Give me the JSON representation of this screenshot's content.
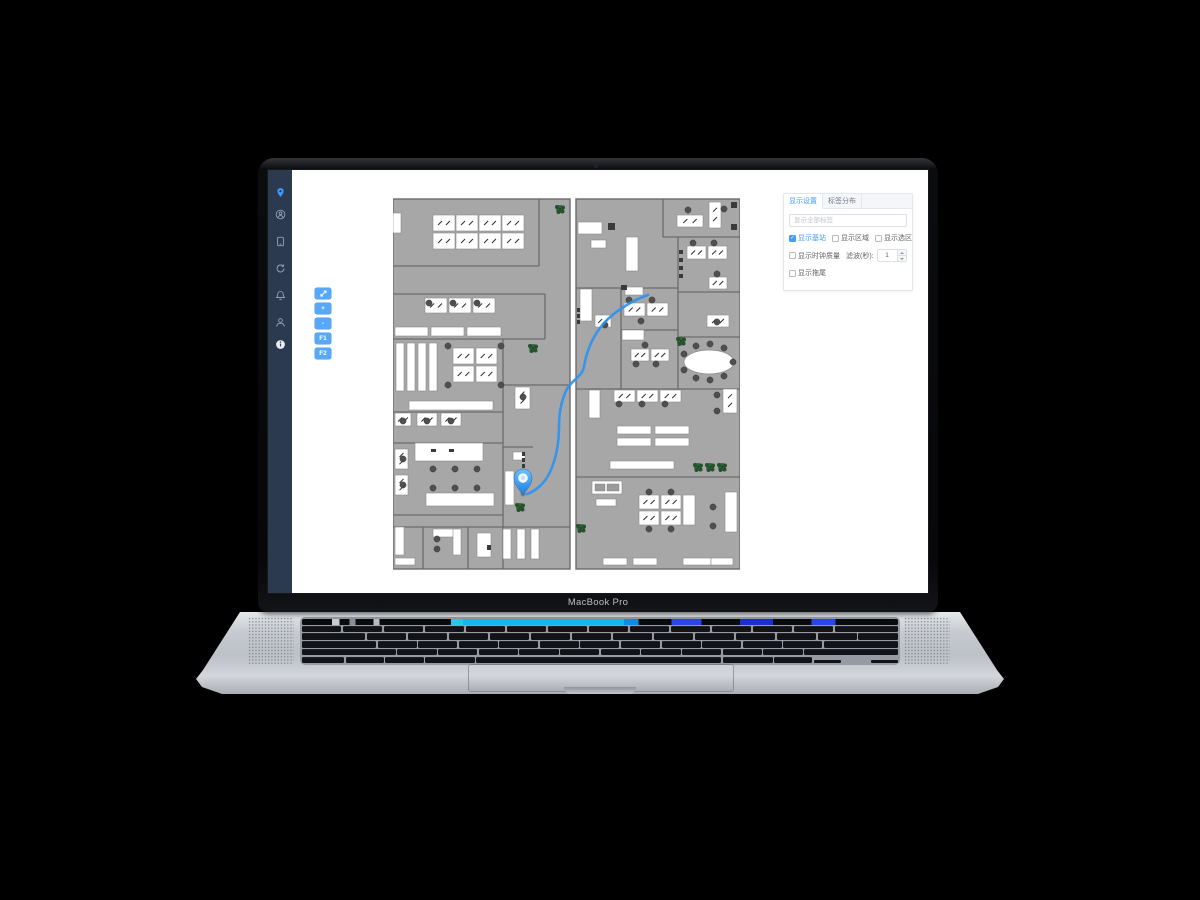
{
  "window": {
    "bezel_label": "MacBook Pro"
  },
  "colors": {
    "accent_blue": "#409eff",
    "sidebar_navy": "#2c3a50",
    "toolbar_blue": "#57a8f7",
    "route_blue": "#2e93f2",
    "room_gray": "#a7a7a7",
    "wall_gray": "#6b6b6b",
    "plant_green": "#31663a"
  },
  "sidebar": {
    "icons": [
      {
        "name": "location-pin",
        "active": true
      },
      {
        "name": "user-circle",
        "active": false
      },
      {
        "name": "tablet-device",
        "active": false
      },
      {
        "name": "history-refresh",
        "active": false
      },
      {
        "name": "notification-bell",
        "active": false
      },
      {
        "name": "user",
        "active": false
      },
      {
        "name": "info",
        "active": false
      }
    ]
  },
  "map_toolbar": {
    "buttons": [
      {
        "name": "fit-screen-button",
        "icon": "fit-screen",
        "label": ""
      },
      {
        "name": "zoom-in-button",
        "icon": "",
        "label": "+"
      },
      {
        "name": "zoom-out-button",
        "icon": "",
        "label": "-"
      },
      {
        "name": "floor-f1-button",
        "icon": "",
        "label": "F1"
      },
      {
        "name": "floor-f2-button",
        "icon": "",
        "label": "F2"
      }
    ]
  },
  "settings_panel": {
    "tabs": [
      {
        "label": "显示设置",
        "active": true
      },
      {
        "label": "标签分布",
        "active": false
      }
    ],
    "search_placeholder": "显示全部标签",
    "checkbox_row1": [
      {
        "name": "show-base-stations",
        "label": "显示基站",
        "checked": true
      },
      {
        "name": "show-areas",
        "label": "显示区域",
        "checked": false
      },
      {
        "name": "show-zones",
        "label": "显示选区",
        "checked": false
      }
    ],
    "row2": {
      "name": "show-clock-quality",
      "label": "显示时钟质量",
      "checked": false,
      "suffix": "滤波(秒):",
      "value": "1"
    },
    "row3": {
      "name": "show-trail",
      "label": "显示拖尾",
      "checked": false
    }
  },
  "floorplan": {
    "width": 347,
    "height": 375,
    "rooms": [
      [
        0,
        2,
        177,
        370
      ],
      [
        183,
        2,
        164,
        370
      ]
    ],
    "walls": [
      [
        0,
        69,
        146,
        69
      ],
      [
        146,
        2,
        146,
        69
      ],
      [
        0,
        97,
        152,
        97
      ],
      [
        152,
        97,
        152,
        142
      ],
      [
        0,
        142,
        152,
        142
      ],
      [
        110,
        142,
        110,
        372
      ],
      [
        110,
        188,
        177,
        188
      ],
      [
        0,
        215,
        110,
        215
      ],
      [
        0,
        246,
        110,
        246
      ],
      [
        0,
        318,
        110,
        318
      ],
      [
        0,
        330,
        177,
        330
      ],
      [
        30,
        330,
        30,
        372
      ],
      [
        75,
        330,
        75,
        372
      ],
      [
        110,
        250,
        140,
        250
      ],
      [
        270,
        2,
        270,
        40
      ],
      [
        270,
        40,
        347,
        40
      ],
      [
        285,
        40,
        285,
        192
      ],
      [
        285,
        95,
        347,
        95
      ],
      [
        285,
        140,
        347,
        140
      ],
      [
        183,
        91,
        285,
        91
      ],
      [
        228,
        91,
        228,
        192
      ],
      [
        228,
        133,
        285,
        133
      ],
      [
        183,
        192,
        347,
        192
      ],
      [
        183,
        280,
        347,
        280
      ]
    ],
    "bars": [
      [
        2,
        130,
        33,
        9
      ],
      [
        38,
        130,
        33,
        9
      ],
      [
        74,
        130,
        34,
        9
      ],
      [
        3,
        146,
        8,
        48
      ],
      [
        14,
        146,
        8,
        48
      ],
      [
        25,
        146,
        8,
        48
      ],
      [
        36,
        146,
        8,
        48
      ],
      [
        16,
        204,
        84,
        9
      ],
      [
        22,
        246,
        68,
        18
      ],
      [
        33,
        296,
        68,
        13
      ],
      [
        112,
        274,
        9,
        34
      ],
      [
        120,
        255,
        12,
        8
      ],
      [
        2,
        330,
        9,
        28
      ],
      [
        40,
        332,
        26,
        8
      ],
      [
        60,
        332,
        8,
        26
      ],
      [
        84,
        336,
        14,
        24
      ],
      [
        110,
        332,
        8,
        30
      ],
      [
        124,
        332,
        8,
        30
      ],
      [
        138,
        332,
        8,
        30
      ],
      [
        0,
        16,
        8,
        20
      ],
      [
        2,
        361,
        20,
        7
      ],
      [
        185,
        25,
        24,
        12
      ],
      [
        233,
        40,
        12,
        34
      ],
      [
        198,
        43,
        15,
        8
      ],
      [
        187,
        92,
        12,
        32
      ],
      [
        232,
        90,
        18,
        8
      ],
      [
        229,
        133,
        22,
        10
      ],
      [
        224,
        229,
        34,
        8
      ],
      [
        262,
        229,
        34,
        8
      ],
      [
        224,
        241,
        34,
        8
      ],
      [
        262,
        241,
        34,
        8
      ],
      [
        217,
        264,
        64,
        8
      ],
      [
        196,
        193,
        11,
        28
      ],
      [
        199,
        284,
        30,
        13
      ],
      [
        203,
        302,
        20,
        7
      ],
      [
        332,
        295,
        12,
        40
      ],
      [
        290,
        298,
        12,
        30
      ],
      [
        210,
        361,
        24,
        7
      ],
      [
        240,
        361,
        24,
        7
      ],
      [
        290,
        361,
        28,
        7
      ],
      [
        318,
        361,
        22,
        7
      ]
    ],
    "desks": [
      [
        40,
        18,
        22,
        16
      ],
      [
        63,
        18,
        22,
        16
      ],
      [
        86,
        18,
        22,
        16
      ],
      [
        109,
        18,
        22,
        16
      ],
      [
        40,
        36,
        22,
        16
      ],
      [
        63,
        36,
        22,
        16
      ],
      [
        86,
        36,
        22,
        16
      ],
      [
        109,
        36,
        22,
        16
      ],
      [
        32,
        101,
        22,
        15
      ],
      [
        56,
        101,
        22,
        15
      ],
      [
        80,
        101,
        22,
        15
      ],
      [
        60,
        151,
        21,
        16
      ],
      [
        83,
        151,
        21,
        16
      ],
      [
        60,
        169,
        21,
        16
      ],
      [
        83,
        169,
        21,
        16
      ],
      [
        2,
        216,
        16,
        13
      ],
      [
        24,
        216,
        20,
        13
      ],
      [
        48,
        216,
        20,
        13
      ],
      [
        2,
        252,
        13,
        20
      ],
      [
        2,
        278,
        13,
        20
      ],
      [
        122,
        190,
        15,
        22
      ],
      [
        284,
        18,
        26,
        12
      ],
      [
        316,
        5,
        12,
        26
      ],
      [
        294,
        49,
        19,
        13
      ],
      [
        315,
        49,
        19,
        13
      ],
      [
        316,
        80,
        18,
        12
      ],
      [
        314,
        118,
        22,
        12
      ],
      [
        231,
        106,
        21,
        13
      ],
      [
        254,
        106,
        21,
        13
      ],
      [
        238,
        152,
        18,
        12
      ],
      [
        258,
        152,
        18,
        12
      ],
      [
        202,
        118,
        16,
        12
      ],
      [
        221,
        193,
        21,
        12
      ],
      [
        244,
        193,
        21,
        12
      ],
      [
        267,
        193,
        21,
        12
      ],
      [
        330,
        192,
        14,
        24
      ],
      [
        246,
        298,
        20,
        14
      ],
      [
        268,
        298,
        20,
        14
      ],
      [
        246,
        314,
        20,
        14
      ],
      [
        268,
        314,
        20,
        14
      ]
    ],
    "chairs": [
      [
        36,
        106
      ],
      [
        60,
        106
      ],
      [
        84,
        106
      ],
      [
        55,
        149
      ],
      [
        108,
        149
      ],
      [
        55,
        188
      ],
      [
        108,
        188
      ],
      [
        10,
        224
      ],
      [
        34,
        224
      ],
      [
        58,
        224
      ],
      [
        10,
        262
      ],
      [
        10,
        288
      ],
      [
        40,
        272
      ],
      [
        62,
        272
      ],
      [
        84,
        272
      ],
      [
        40,
        291
      ],
      [
        62,
        291
      ],
      [
        84,
        291
      ],
      [
        130,
        200
      ],
      [
        295,
        13
      ],
      [
        331,
        12
      ],
      [
        300,
        46
      ],
      [
        321,
        46
      ],
      [
        324,
        77
      ],
      [
        324,
        125
      ],
      [
        236,
        103
      ],
      [
        259,
        103
      ],
      [
        248,
        124
      ],
      [
        243,
        167
      ],
      [
        263,
        167
      ],
      [
        252,
        148
      ],
      [
        212,
        128
      ],
      [
        226,
        207
      ],
      [
        249,
        207
      ],
      [
        272,
        207
      ],
      [
        324,
        198
      ],
      [
        324,
        214
      ],
      [
        256,
        295
      ],
      [
        278,
        295
      ],
      [
        256,
        332
      ],
      [
        278,
        332
      ],
      [
        320,
        310
      ],
      [
        320,
        329
      ],
      [
        291,
        157
      ],
      [
        291,
        173
      ],
      [
        303,
        149
      ],
      [
        303,
        181
      ],
      [
        317,
        147
      ],
      [
        317,
        183
      ],
      [
        331,
        151
      ],
      [
        331,
        179
      ],
      [
        340,
        165
      ],
      [
        44,
        342
      ],
      [
        44,
        352
      ]
    ],
    "items": [
      [
        129,
        255,
        3,
        4
      ],
      [
        129,
        261,
        3,
        4
      ],
      [
        129,
        267,
        3,
        4
      ],
      [
        184,
        111,
        3,
        4
      ],
      [
        184,
        117,
        3,
        4
      ],
      [
        184,
        123,
        3,
        4
      ],
      [
        286,
        53,
        4,
        4
      ],
      [
        286,
        61,
        4,
        4
      ],
      [
        286,
        69,
        4,
        4
      ],
      [
        286,
        77,
        4,
        4
      ],
      [
        215,
        26,
        7,
        7
      ],
      [
        228,
        88,
        6,
        5
      ],
      [
        338,
        5,
        6,
        6
      ],
      [
        338,
        27,
        6,
        6
      ],
      [
        94,
        348,
        4,
        5
      ],
      [
        38,
        252,
        5,
        3
      ],
      [
        56,
        252,
        5,
        3
      ]
    ],
    "panes": [
      [
        202,
        287,
        10,
        7
      ],
      [
        214,
        287,
        12,
        7
      ]
    ],
    "plants": [
      [
        167,
        12
      ],
      [
        140,
        151
      ],
      [
        127,
        310
      ],
      [
        188,
        331
      ],
      [
        305,
        270
      ],
      [
        317,
        270
      ],
      [
        329,
        270
      ],
      [
        288,
        144
      ]
    ],
    "oval_table": {
      "cx": 316,
      "cy": 165,
      "rx": 25,
      "ry": 12
    },
    "route_path": "M255,98 C238,104 218,116 207,131 C198,143 193,157 191,170 C189,180 177,184 173,194 C168,205 166,216 166,229 C166,246 163,262 157,275 C152,286 143,294 134,297",
    "pin": {
      "x": 130,
      "y": 281
    }
  }
}
